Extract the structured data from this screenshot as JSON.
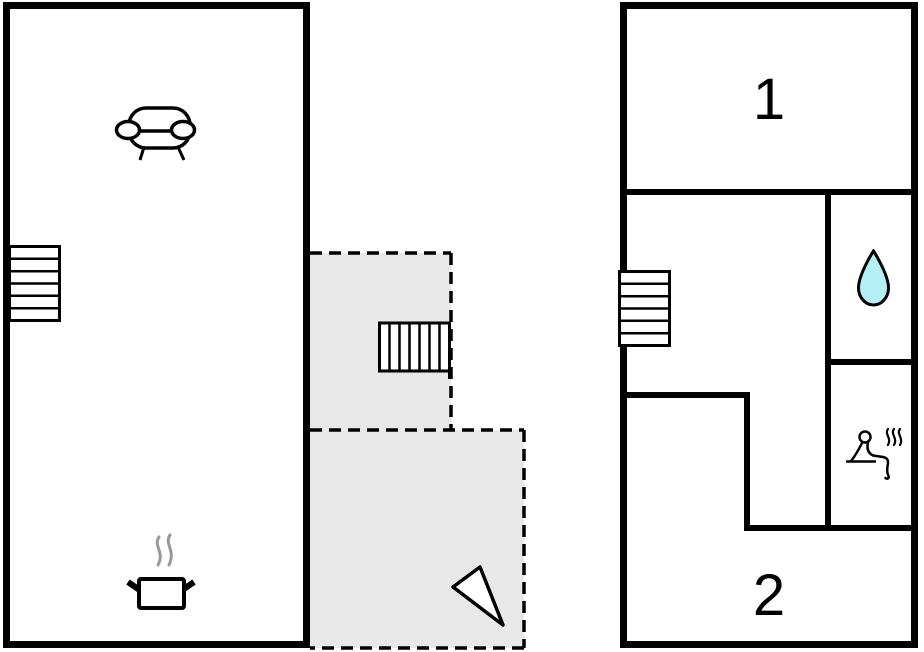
{
  "rooms": {
    "room1_label": "1",
    "room2_label": "2"
  },
  "icons": {
    "left_plan": [
      "sofa-icon",
      "staircase-icon",
      "cooking-pot-icon"
    ],
    "annex": [
      "staircase-icon",
      "north-arrow-icon"
    ],
    "right_plan": [
      "staircase-icon",
      "water-drop-icon",
      "sauna-icon"
    ]
  },
  "colors": {
    "wall": "#000000",
    "annex_fill": "#e8e8e8",
    "water_drop_fill": "#b4eef6",
    "steam_gray": "#999999"
  }
}
